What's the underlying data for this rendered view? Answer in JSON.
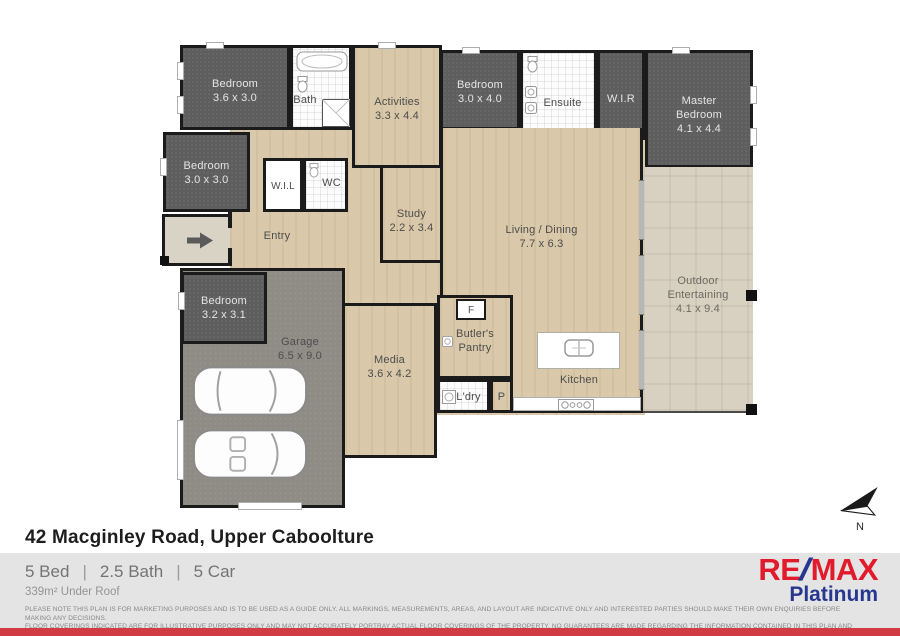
{
  "plan": {
    "compass_label": "N",
    "rooms": {
      "bed1": {
        "name": "Bedroom",
        "dims": "3.6 x 3.0"
      },
      "bath": {
        "name": "Bath"
      },
      "activities": {
        "name": "Activities",
        "dims": "3.3 x 4.4"
      },
      "bed2": {
        "name": "Bedroom",
        "dims": "3.0 x 4.0"
      },
      "ensuite": {
        "name": "Ensuite"
      },
      "wir": {
        "name": "W.I.R"
      },
      "master": {
        "name": "Master Bedroom",
        "dims": "4.1 x 4.4"
      },
      "bed3": {
        "name": "Bedroom",
        "dims": "3.0 x 3.0"
      },
      "wil": {
        "name": "W.I.L"
      },
      "wc": {
        "name": "WC"
      },
      "entry": {
        "name": "Entry"
      },
      "study": {
        "name": "Study",
        "dims": "2.2 x 3.4"
      },
      "living": {
        "name": "Living / Dining",
        "dims": "7.7 x 6.3"
      },
      "outdoor": {
        "name": "Outdoor Entertaining",
        "dims": "4.1 x 9.4"
      },
      "bed4": {
        "name": "Bedroom",
        "dims": "3.2 x 3.1"
      },
      "garage": {
        "name": "Garage",
        "dims": "6.5 x 9.0"
      },
      "media": {
        "name": "Media",
        "dims": "3.6 x 4.2"
      },
      "butlers": {
        "name": "Butler's Pantry"
      },
      "ldry": {
        "name": "L'dry"
      },
      "pantry": {
        "name": "P"
      },
      "kitchen": {
        "name": "Kitchen"
      },
      "fridge": {
        "name": "F"
      }
    }
  },
  "footer": {
    "address": "42 Macginley Road, Upper Caboolture",
    "stats": {
      "beds": "5 Bed",
      "baths": "2.5 Bath",
      "cars": "5 Car",
      "separator": "|"
    },
    "area": "339m² Under Roof",
    "disclaimer_line1": "PLEASE NOTE THIS PLAN IS FOR MARKETING PURPOSES AND IS TO BE USED AS A GUIDE ONLY.  ALL MARKINGS, MEASUREMENTS, AREAS, AND LAYOUT ARE INDICATIVE ONLY AND INTERESTED PARTIES SHOULD MAKE THEIR OWN ENQUIRIES BEFORE MAKING ANY DECISIONS.",
    "disclaimer_line2": "FLOOR COVERINGS INDICATED ARE FOR ILLUSTRATIVE PURPOSES ONLY AND MAY NOT ACCURATELY PORTRAY ACTUAL FLOOR COVERINGS OF THE PROPERTY.  NO GUARANTEES ARE MADE REGARDING THE INFORMATION CONTAINED IN THIS PLAN AND NO LIABILITY FOR  ANY INACCURACIES IS ACCEPTED ."
  },
  "brand": {
    "re": "RE",
    "slash": "/",
    "max": "MAX",
    "name": "Platinum"
  },
  "colors": {
    "brand-red": "#e11a2c",
    "brand-blue": "#27368f",
    "bar-red": "#d13b44",
    "footer-gray": "#e4e4e4",
    "carpet": "#5e5e5e",
    "timber": "#d9c8a9",
    "outdoor-tile": "#d8d0c1",
    "garage-floor": "#8f8c85"
  }
}
